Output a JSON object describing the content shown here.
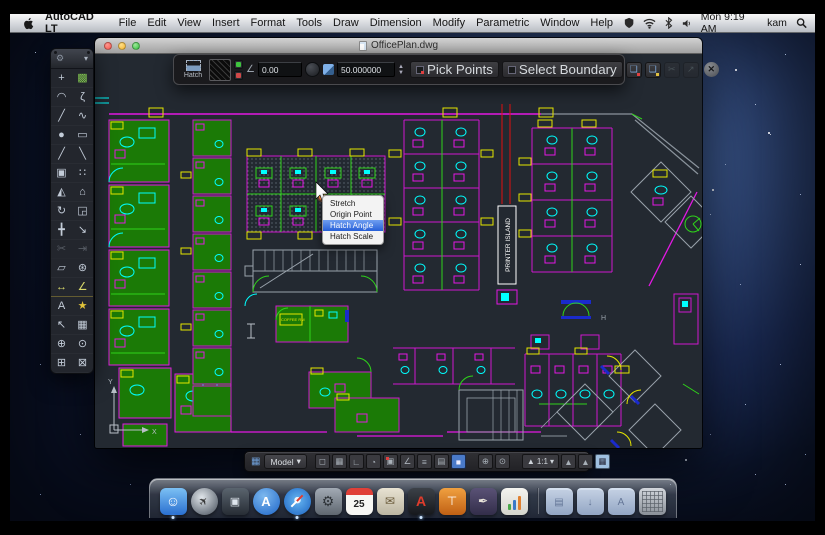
{
  "menubar": {
    "app_name": "AutoCAD LT",
    "items": [
      "File",
      "Edit",
      "View",
      "Insert",
      "Format",
      "Tools",
      "Draw",
      "Dimension",
      "Modify",
      "Parametric",
      "Window",
      "Help"
    ],
    "clock": "Mon 9:19 AM",
    "user": "kam"
  },
  "window": {
    "title": "OfficePlan.dwg"
  },
  "hatch_toolbar": {
    "tool_label": "Hatch",
    "angle_value": "0.00",
    "scale_value": "50.000000",
    "pick_points_label": "Pick Points",
    "select_boundary_label": "Select Boundary",
    "icon_buttons": [
      {
        "name": "add-boundary-icon",
        "glyph": "❏",
        "mark": "red",
        "disabled": false
      },
      {
        "name": "new-boundary-set-icon",
        "glyph": "❏",
        "mark": "yellow",
        "disabled": false
      },
      {
        "name": "trim-hatch-icon",
        "glyph": "✂",
        "mark": "",
        "disabled": true
      },
      {
        "name": "inherit-properties-icon",
        "glyph": "↗",
        "mark": "",
        "disabled": true
      }
    ],
    "close_glyph": "✕"
  },
  "context_menu": {
    "items": [
      "Stretch",
      "Origin Point",
      "Hatch Angle",
      "Hatch Scale"
    ],
    "highlighted": "Hatch Angle"
  },
  "palette": {
    "tools": [
      {
        "name": "selection-tool",
        "glyph": "+",
        "accent": ""
      },
      {
        "name": "hatch-tool",
        "glyph": "▩",
        "accent": "accent-green"
      },
      {
        "name": "arc-tool",
        "glyph": "◠",
        "accent": ""
      },
      {
        "name": "spline-tool",
        "glyph": "ζ",
        "accent": ""
      },
      {
        "name": "line-tool",
        "glyph": "╱",
        "accent": ""
      },
      {
        "name": "polyline-tool",
        "glyph": "∿",
        "accent": ""
      },
      {
        "name": "circle-tool",
        "glyph": "●",
        "accent": ""
      },
      {
        "name": "rectangle-tool",
        "glyph": "▭",
        "accent": ""
      },
      {
        "name": "construction-line-tool",
        "glyph": "╱",
        "accent": ""
      },
      {
        "name": "ray-tool",
        "glyph": "╲",
        "accent": ""
      },
      {
        "name": "copy-tool",
        "glyph": "▣",
        "accent": ""
      },
      {
        "name": "array-tool",
        "glyph": "∷",
        "accent": ""
      },
      {
        "name": "mirror-tool",
        "glyph": "◭",
        "accent": ""
      },
      {
        "name": "polygon-tool",
        "glyph": "⌂",
        "accent": ""
      },
      {
        "name": "rotate-tool",
        "glyph": "↻",
        "accent": ""
      },
      {
        "name": "scale-tool",
        "glyph": "◲",
        "accent": ""
      },
      {
        "name": "move-tool",
        "glyph": "╋",
        "accent": ""
      },
      {
        "name": "stretch-tool",
        "glyph": "↘",
        "accent": ""
      },
      {
        "name": "trim-tool",
        "glyph": "✂",
        "accent": "dim"
      },
      {
        "name": "extend-tool",
        "glyph": "⇥",
        "accent": "dim"
      },
      {
        "name": "erase-tool",
        "glyph": "▱",
        "accent": ""
      },
      {
        "name": "explode-tool",
        "glyph": "⊛",
        "accent": ""
      },
      {
        "name": "linear-dimension-tool",
        "glyph": "↔",
        "accent": "accent-dim"
      },
      {
        "name": "angular-dimension-tool",
        "glyph": "∠",
        "accent": "accent-dim"
      },
      {
        "name": "text-tool",
        "glyph": "A",
        "accent": ""
      },
      {
        "name": "insert-block-tool",
        "glyph": "★",
        "accent": "accent-yellow"
      },
      {
        "name": "leader-tool",
        "glyph": "↖",
        "accent": ""
      },
      {
        "name": "table-tool",
        "glyph": "▦",
        "accent": ""
      },
      {
        "name": "pan-tool",
        "glyph": "⊕",
        "accent": ""
      },
      {
        "name": "zoom-tool",
        "glyph": "⊙",
        "accent": ""
      },
      {
        "name": "zoom-window-tool",
        "glyph": "⊞",
        "accent": ""
      },
      {
        "name": "zoom-extents-tool",
        "glyph": "⊠",
        "accent": ""
      }
    ]
  },
  "statusbar": {
    "model_label": "Model",
    "dropdown_glyph": "▾",
    "annotation_scale": "1:1",
    "toggles": [
      {
        "name": "snap-toggle",
        "glyph": "◻",
        "active": false,
        "badge": false
      },
      {
        "name": "grid-toggle",
        "glyph": "▦",
        "active": false,
        "badge": false
      },
      {
        "name": "ortho-toggle",
        "glyph": "∟",
        "active": false,
        "badge": false
      },
      {
        "name": "polar-toggle",
        "glyph": "◔",
        "active": false,
        "badge": false
      },
      {
        "name": "osnap-toggle",
        "glyph": "▣",
        "active": false,
        "badge": true
      },
      {
        "name": "otrack-toggle",
        "glyph": "∠",
        "active": false,
        "badge": false
      },
      {
        "name": "lineweight-toggle",
        "glyph": "≡",
        "active": false,
        "badge": false
      },
      {
        "name": "properties-toggle",
        "glyph": "▤",
        "active": false,
        "badge": false
      },
      {
        "name": "quick-properties-toggle",
        "glyph": "■",
        "active": true,
        "badge": false
      }
    ],
    "nav": [
      {
        "name": "pan-button",
        "glyph": "⊕"
      },
      {
        "name": "zoom-button",
        "glyph": "⊙"
      }
    ],
    "annotation_buttons": [
      {
        "name": "annotation-autoscale-button",
        "glyph": "▲"
      },
      {
        "name": "annotation-visibility-button",
        "glyph": "▲"
      }
    ],
    "screen_glyph": "▦"
  },
  "dock": {
    "calendar_day": "25",
    "icons": [
      {
        "name": "finder-dock-icon",
        "style": "di-finder",
        "glyph": "☺",
        "running": true
      },
      {
        "name": "launchpad-dock-icon",
        "style": "di-launchpad",
        "glyph": "✈",
        "running": false
      },
      {
        "name": "mission-control-dock-icon",
        "style": "di-mission",
        "glyph": "▣",
        "running": false
      },
      {
        "name": "app-store-dock-icon",
        "style": "di-appstore",
        "glyph": "A",
        "running": false
      },
      {
        "name": "safari-dock-icon",
        "style": "di-safari",
        "glyph": "",
        "running": true
      },
      {
        "name": "system-preferences-dock-icon",
        "style": "di-prefs",
        "glyph": "⚙",
        "running": false
      },
      {
        "name": "calendar-dock-icon",
        "style": "di-calendar",
        "glyph": "25",
        "running": false
      },
      {
        "name": "mail-dock-icon",
        "style": "di-mail",
        "glyph": "✉",
        "running": false
      },
      {
        "name": "autocad-dock-icon",
        "style": "di-autocad",
        "glyph": "A",
        "running": true
      },
      {
        "name": "keynote-dock-icon",
        "style": "di-keynote",
        "glyph": "⊤",
        "running": false
      },
      {
        "name": "pages-dock-icon",
        "style": "di-pages",
        "glyph": "✒",
        "running": false
      },
      {
        "name": "numbers-dock-icon",
        "style": "di-numbers",
        "glyph": "",
        "running": false
      },
      {
        "name": "separator",
        "style": "sep",
        "glyph": "",
        "running": false
      },
      {
        "name": "documents-folder-dock-icon",
        "style": "di-folder",
        "glyph": "▤",
        "running": false
      },
      {
        "name": "downloads-folder-dock-icon",
        "style": "di-folder",
        "glyph": "↓",
        "running": false
      },
      {
        "name": "applications-folder-dock-icon",
        "style": "di-folder",
        "glyph": "A",
        "running": false
      },
      {
        "name": "trash-dock-icon",
        "style": "di-trash",
        "glyph": "",
        "running": false
      }
    ]
  },
  "drawing": {
    "printer_island": "PRINTER ISLAND",
    "coffee_label": "COFFEE RM",
    "h_label": "H",
    "axis_y": "Y",
    "axis_x": "X"
  },
  "colors": {
    "selection_blue": "#2760d8",
    "cad_magenta": "#e318e3",
    "cad_green_fill": "#1b7a06",
    "cad_green_line": "#2fd41a",
    "cad_cyan": "#00ffff",
    "cad_yellow": "#e6e600",
    "cad_red": "#e01010",
    "canvas_bg": "#232931"
  }
}
